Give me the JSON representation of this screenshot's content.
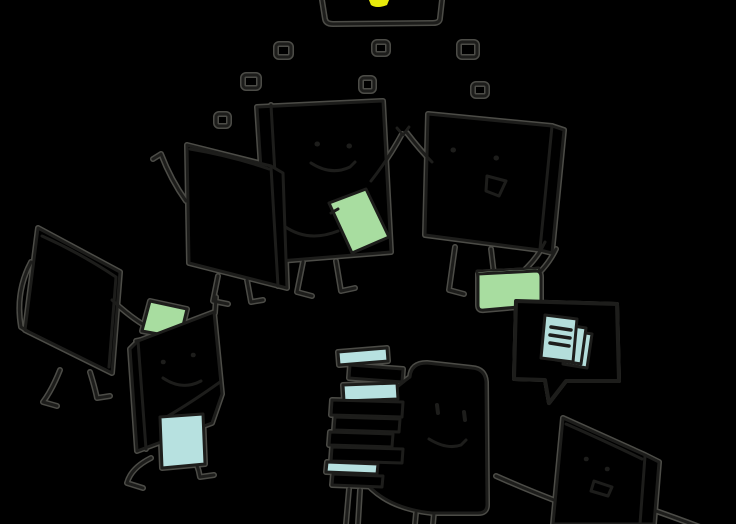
{
  "scene": {
    "kind": "hand-drawn-illustration",
    "figures": [
      "laptop-top-edge-with-logo",
      "floating-squares",
      "smiling-book-character-holding-phone",
      "tilted-book-character-waving",
      "laughing-book-character-with-folder",
      "speech-bubble-with-documents",
      "back-view-book-character",
      "small-walking-book-character-with-papers",
      "character-carrying-book-stack",
      "bottom-right-book-character"
    ],
    "colors": {
      "background": "#000000",
      "ink": "#1d1d1b",
      "halo": "#8b8b82",
      "green": "#a8dda0",
      "greenLight": "#c8ebc0",
      "teal": "#b4dedb",
      "blue": "#b7e1e0",
      "yellow": "#e7ea0b"
    }
  }
}
